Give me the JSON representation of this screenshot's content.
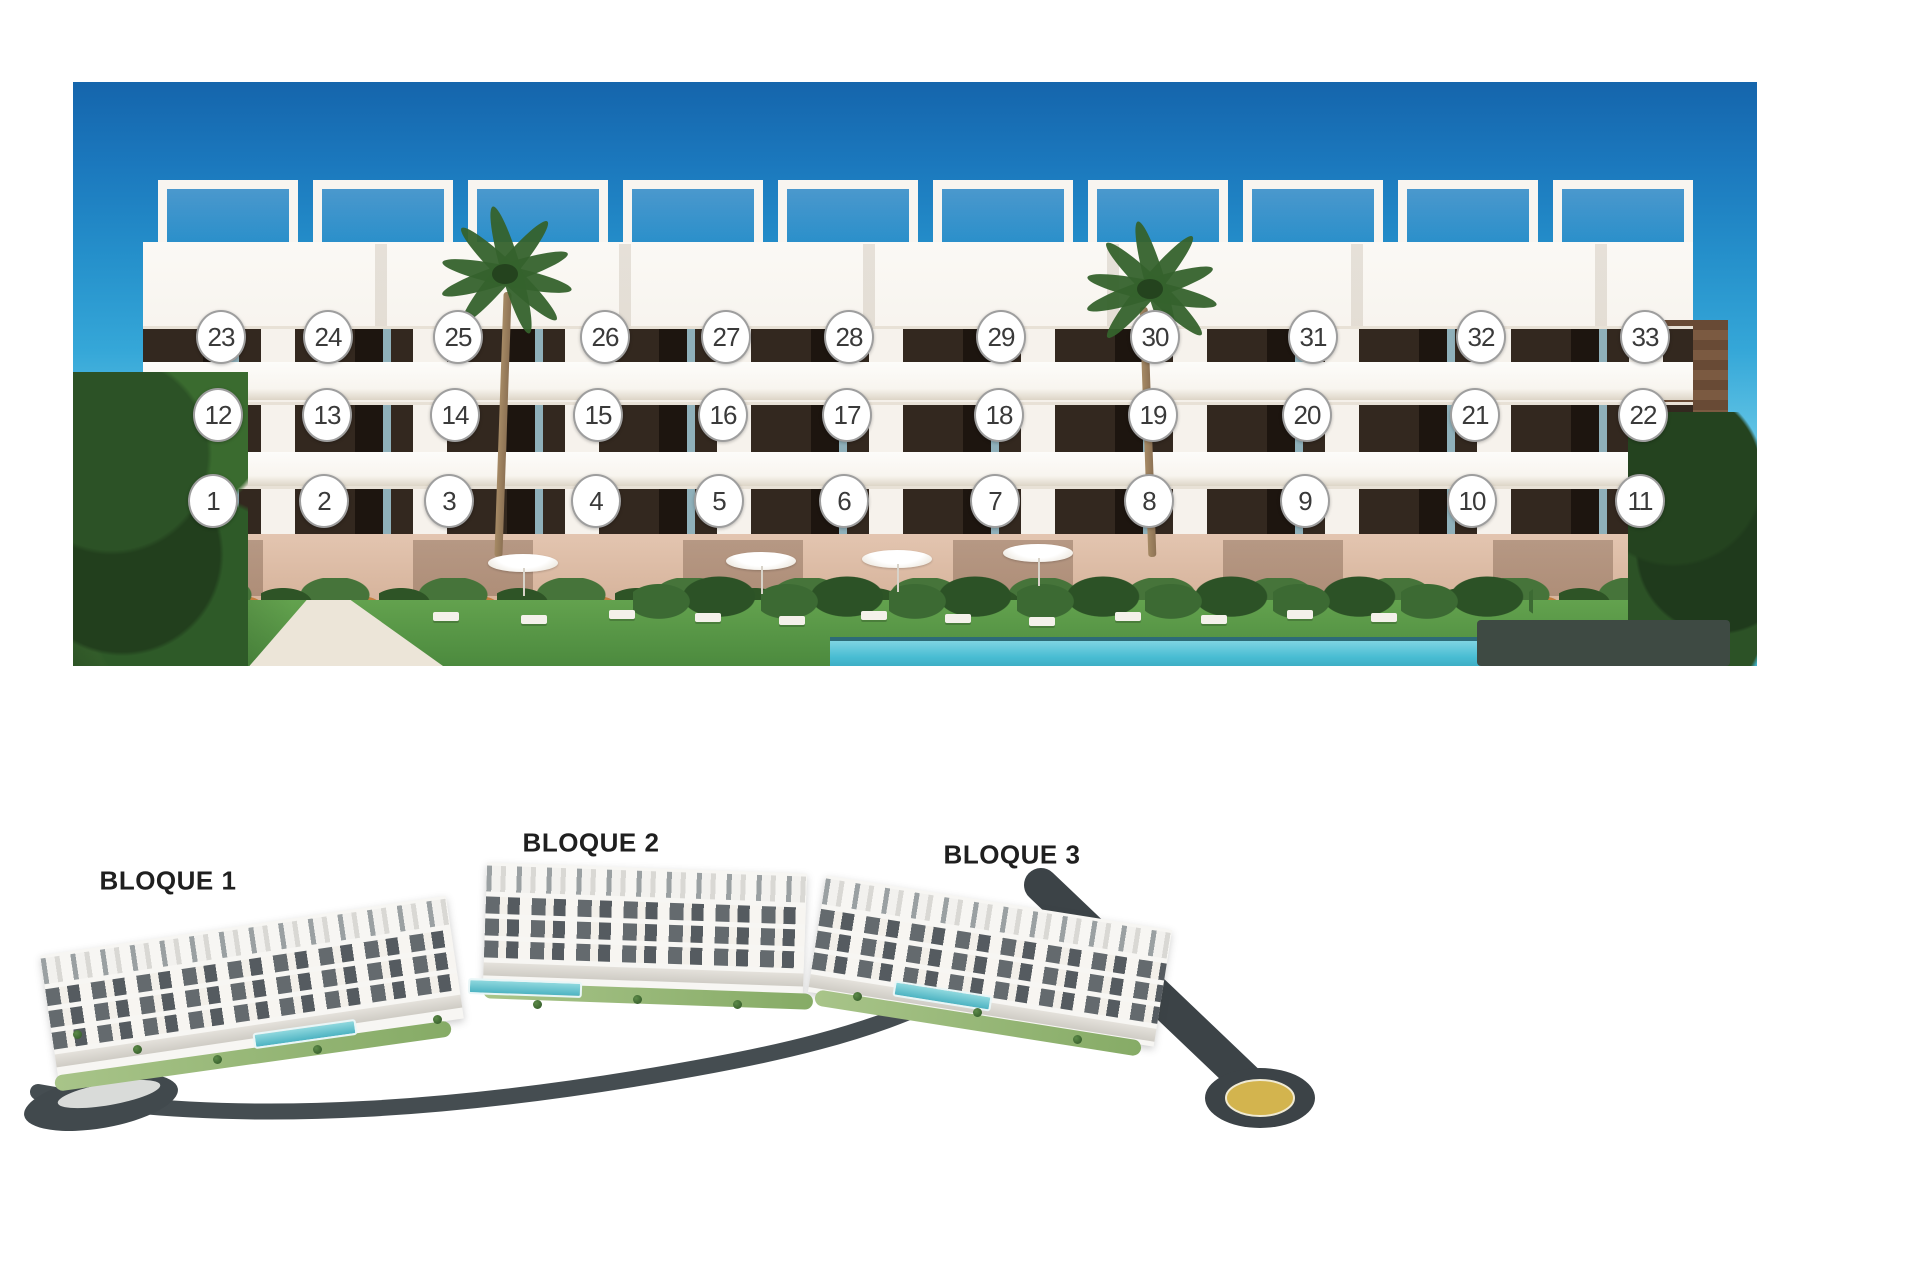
{
  "facade": {
    "description": "Frontal render of white apartment building with 33 numbered unit badges over three floors, palm trees, garden and pool",
    "badge_colors": {
      "fill": "#ffffff",
      "border": "#9e9e9e",
      "text": "#3a3a3a"
    },
    "badges": [
      {
        "label": "1",
        "x": 140,
        "y": 419
      },
      {
        "label": "2",
        "x": 251,
        "y": 419
      },
      {
        "label": "3",
        "x": 376,
        "y": 419
      },
      {
        "label": "4",
        "x": 523,
        "y": 419
      },
      {
        "label": "5",
        "x": 646,
        "y": 419
      },
      {
        "label": "6",
        "x": 771,
        "y": 419
      },
      {
        "label": "7",
        "x": 922,
        "y": 419
      },
      {
        "label": "8",
        "x": 1076,
        "y": 419
      },
      {
        "label": "9",
        "x": 1232,
        "y": 419
      },
      {
        "label": "10",
        "x": 1399,
        "y": 419
      },
      {
        "label": "11",
        "x": 1567,
        "y": 419
      },
      {
        "label": "12",
        "x": 145,
        "y": 333
      },
      {
        "label": "13",
        "x": 254,
        "y": 333
      },
      {
        "label": "14",
        "x": 382,
        "y": 333
      },
      {
        "label": "15",
        "x": 525,
        "y": 333
      },
      {
        "label": "16",
        "x": 650,
        "y": 333
      },
      {
        "label": "17",
        "x": 774,
        "y": 333
      },
      {
        "label": "18",
        "x": 926,
        "y": 333
      },
      {
        "label": "19",
        "x": 1080,
        "y": 333
      },
      {
        "label": "20",
        "x": 1234,
        "y": 333
      },
      {
        "label": "21",
        "x": 1402,
        "y": 333
      },
      {
        "label": "22",
        "x": 1570,
        "y": 333
      },
      {
        "label": "23",
        "x": 148,
        "y": 255
      },
      {
        "label": "24",
        "x": 255,
        "y": 255
      },
      {
        "label": "25",
        "x": 385,
        "y": 255
      },
      {
        "label": "26",
        "x": 532,
        "y": 255
      },
      {
        "label": "27",
        "x": 653,
        "y": 255
      },
      {
        "label": "28",
        "x": 776,
        "y": 255
      },
      {
        "label": "29",
        "x": 928,
        "y": 255
      },
      {
        "label": "30",
        "x": 1082,
        "y": 255
      },
      {
        "label": "31",
        "x": 1240,
        "y": 255
      },
      {
        "label": "32",
        "x": 1408,
        "y": 255
      },
      {
        "label": "33",
        "x": 1572,
        "y": 255
      }
    ]
  },
  "siteplan": {
    "description": "Aerial render of the development with three stepped residential blocks along a curved dark road ending in a roundabout",
    "labels": [
      {
        "text": "BLOQUE 1",
        "x": 155,
        "y": 51
      },
      {
        "text": "BLOQUE 2",
        "x": 578,
        "y": 13
      },
      {
        "text": "BLOQUE 3",
        "x": 999,
        "y": 25
      }
    ],
    "label_color": "#1f1f1f",
    "road_color": "#3f474b",
    "roundabout_gold": "#d3b44e"
  },
  "colors": {
    "sky_top": "#1565ac",
    "sky_horizon": "#c9ecf6",
    "facade_white": "#f6f2ec",
    "window_dark": "#2c221b",
    "stone_base": "#ddbda9",
    "lawn_green": "#5d9c49",
    "pool_teal": "#49bdd3",
    "hedge_dark": "#3e4a43"
  }
}
